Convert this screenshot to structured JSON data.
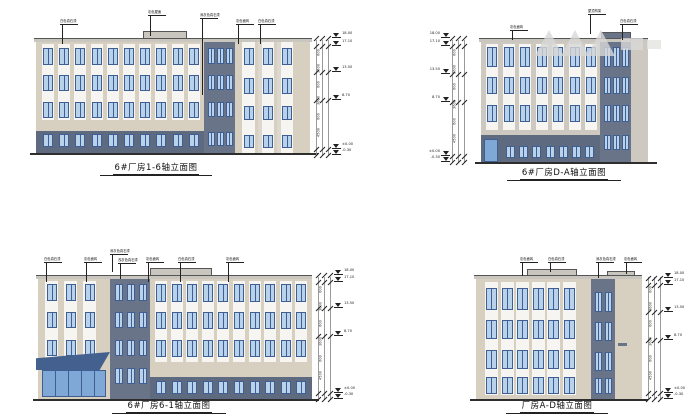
{
  "page": {
    "background": "#ffffff"
  },
  "colors": {
    "wall_beige": "#d7cfc0",
    "wall_gray": "#cdc9c1",
    "band_dark": "#6a7488",
    "base_dark": "#5d6a80",
    "strip_white": "#f6f5f1",
    "strip_light": "#dcd8d0",
    "window_frame": "#3f5f93",
    "window_glass": "#b9d2ec",
    "glass_deep": "#7fa8d6",
    "canopy": "#44608f",
    "parapet": "#c9c6bf",
    "ground": "#2e2e2e",
    "dim_line": "#9a9a9a",
    "ink": "#222222"
  },
  "watermark": {
    "color": "#d8d8d8"
  },
  "elevations": {
    "tl": {
      "title": "6#厂房1-6轴立面图",
      "callouts": [
        "白色真石漆",
        "灰色屋面",
        "深灰色真石漆",
        "灰色面砖",
        "白色真石漆"
      ],
      "levels": [
        "18.00",
        "17.10",
        "13.50",
        "8.70",
        "±0.00",
        "-0.30"
      ],
      "dims": [
        "600",
        "3600",
        "600",
        "3600",
        "600",
        "4500"
      ],
      "window_columns_main": 10,
      "window_rows_main": 3,
      "window_columns_stair": 3,
      "window_columns_wing": 3,
      "base_windows": 10
    },
    "tr": {
      "title": "6#厂房D-A轴立面图",
      "callouts": [
        "灰色面砖",
        "屋顶构架",
        "白色真石漆"
      ],
      "levels": [
        "18.00",
        "17.10",
        "13.50",
        "8.70",
        "±0.00",
        "-0.30"
      ],
      "dims": [
        "600",
        "3600",
        "600",
        "3600",
        "600",
        "4500"
      ],
      "window_columns_main": 7,
      "window_rows_main": 3,
      "window_columns_stair": 3,
      "base_windows": 7
    },
    "bl": {
      "title": "6#厂房6-1轴立面图",
      "callouts": [
        "白色真石漆",
        "灰色面砖",
        "深灰色真石漆",
        "浅灰色真石漆",
        "灰色面砖",
        "白色真石漆",
        "灰色面砖"
      ],
      "levels": [
        "18.00",
        "17.10",
        "13.50",
        "8.70",
        "±0.00",
        "-0.30"
      ],
      "dims": [
        "600",
        "3600",
        "600",
        "3600",
        "600",
        "4500"
      ],
      "window_columns_main": 10,
      "window_rows_main": 3,
      "window_columns_stair": 3,
      "window_columns_wing": 3,
      "base_windows": 10
    },
    "br": {
      "title": "厂房A-D轴立面图",
      "callouts": [
        "灰色面砖",
        "白色真石漆",
        "深灰色真石漆",
        "灰色面砖"
      ],
      "levels": [
        "18.00",
        "17.10",
        "13.50",
        "8.70",
        "±0.00",
        "-0.30"
      ],
      "dims": [
        "600",
        "3600",
        "600",
        "3600",
        "600",
        "4500"
      ],
      "window_columns_main": 6,
      "window_rows_main": 4,
      "window_columns_stair": 2
    }
  }
}
